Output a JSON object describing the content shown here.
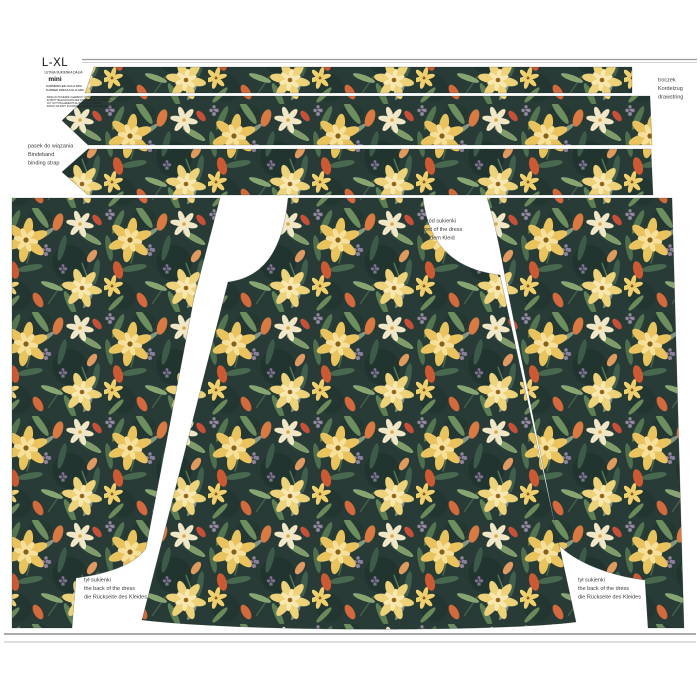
{
  "size_box": {
    "size": "L-XL",
    "collection": "LETNIA SUKIENKA DALIA",
    "name": "mini",
    "subtitle_de": "SOMMERKLEID DALIA MINI",
    "subtitle_en": "SUMMER DRESS DALIA MINI",
    "info_lines": [
      "PANEL NA SUKIENKE / ELEMENTY WYCIAC WZDLUZ KONTUROW",
      "SCHNITTTEILE ENTLANG DER KONTUREN AUSSCHNEIDEN",
      "CUT OUT THE ELEMENTS ALONG THE CONTOURS",
      "ZAPASY NA SZWY SA DODANE / SEAM ALLOWANCE INCLUDED"
    ]
  },
  "labels": {
    "drawstring": [
      "troczek",
      "Kordelzug",
      "drawstring"
    ],
    "binding_strap": [
      "pasek do wiązania",
      "Bindeband",
      "binding strap"
    ],
    "front": [
      "przód sukienki",
      "front of the dress",
      "vor dem Kleid"
    ],
    "back_left": [
      "tył sukienki",
      "the back of the dress",
      "die Rückseite des Kleides"
    ],
    "back_right": [
      "tył sukienki",
      "the back of the dress",
      "die Rückseite des Kleides"
    ]
  },
  "colors": {
    "fabric_background": "#283b36",
    "flower_yellow": "#e9c35d",
    "flower_yellow_light": "#f4dd92",
    "flower_cream": "#f1e7c6",
    "bud_orange": "#d97a42",
    "bud_red": "#cb5a33",
    "leaf_green": "#55754e",
    "leaf_light": "#86a571",
    "sprig_purple": "#8d7f9c",
    "page_background": "#ffffff",
    "label_text": "#3b3b3b"
  }
}
